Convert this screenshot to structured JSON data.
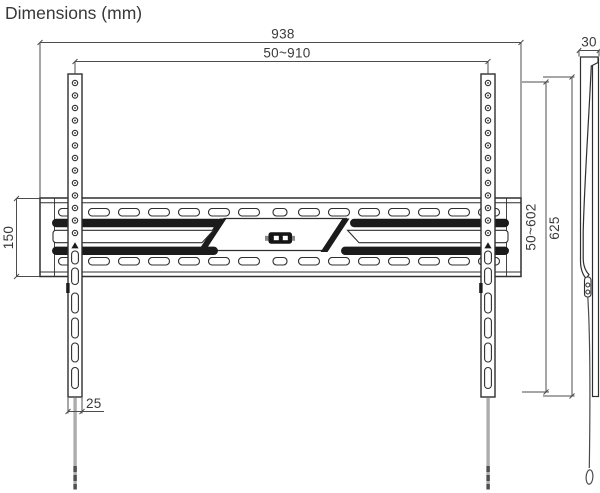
{
  "title": "Dimensions (mm)",
  "dims": {
    "overall_width": "938",
    "hole_span_horizontal": "50~910",
    "depth": "30",
    "plate_height": "150",
    "hole_span_vertical": "50~602",
    "rail_height": "625",
    "rail_width": "25"
  },
  "colors": {
    "outline": "#2f2f2f",
    "dimension_lines": "#4d4d4d",
    "filled_slots": "#1b1b1b",
    "strap": "#adadad",
    "background": "#ffffff"
  }
}
